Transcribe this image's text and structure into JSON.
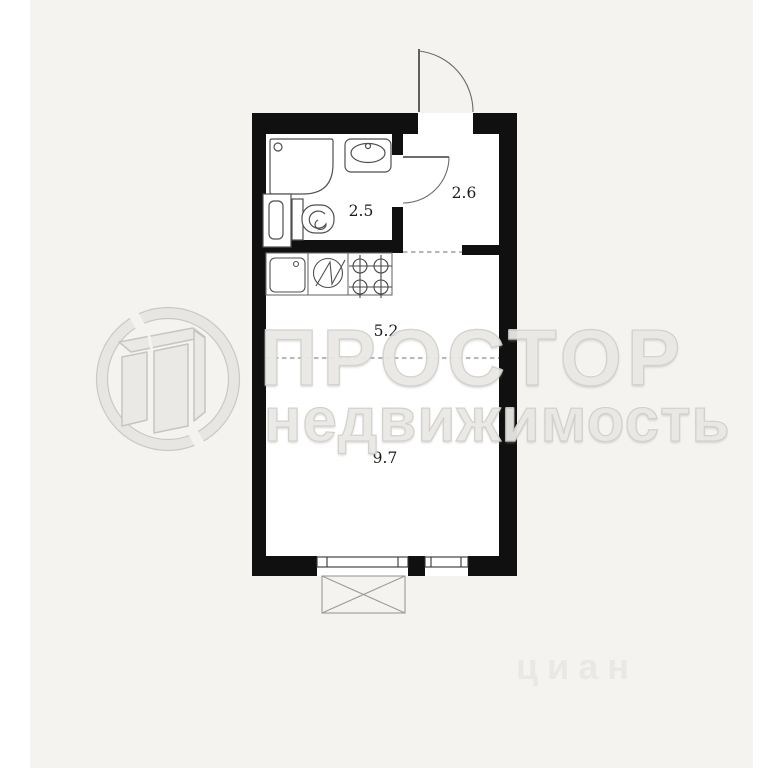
{
  "image": {
    "type": "apartment-floor-plan",
    "background_color": "#f4f3f0",
    "wall_color": "#101010"
  },
  "rooms": [
    {
      "name": "bathroom",
      "area_label": "2.5"
    },
    {
      "name": "hallway",
      "area_label": "2.6"
    },
    {
      "name": "kitchen-zone",
      "area_label": "5.2"
    },
    {
      "name": "living-zone",
      "area_label": "9.7"
    }
  ],
  "fixtures": [
    "shower-tray",
    "washbasin",
    "toilet",
    "bathroom-cabinet",
    "kitchen-sink",
    "washing-machine",
    "stove-4-burners"
  ],
  "features": [
    "entrance-door-swing",
    "bathroom-door-swing",
    "wide-window-balcony-door",
    "narrow-window",
    "balcony-cross-box",
    "zone-dashed-lines"
  ],
  "watermark": {
    "line1": "ПРОСТОР",
    "line2": "недвижимость",
    "logo": "prostor-circle-p-logo",
    "text_color": "#e9e8e5"
  },
  "faint_watermark": {
    "text": "циан"
  }
}
